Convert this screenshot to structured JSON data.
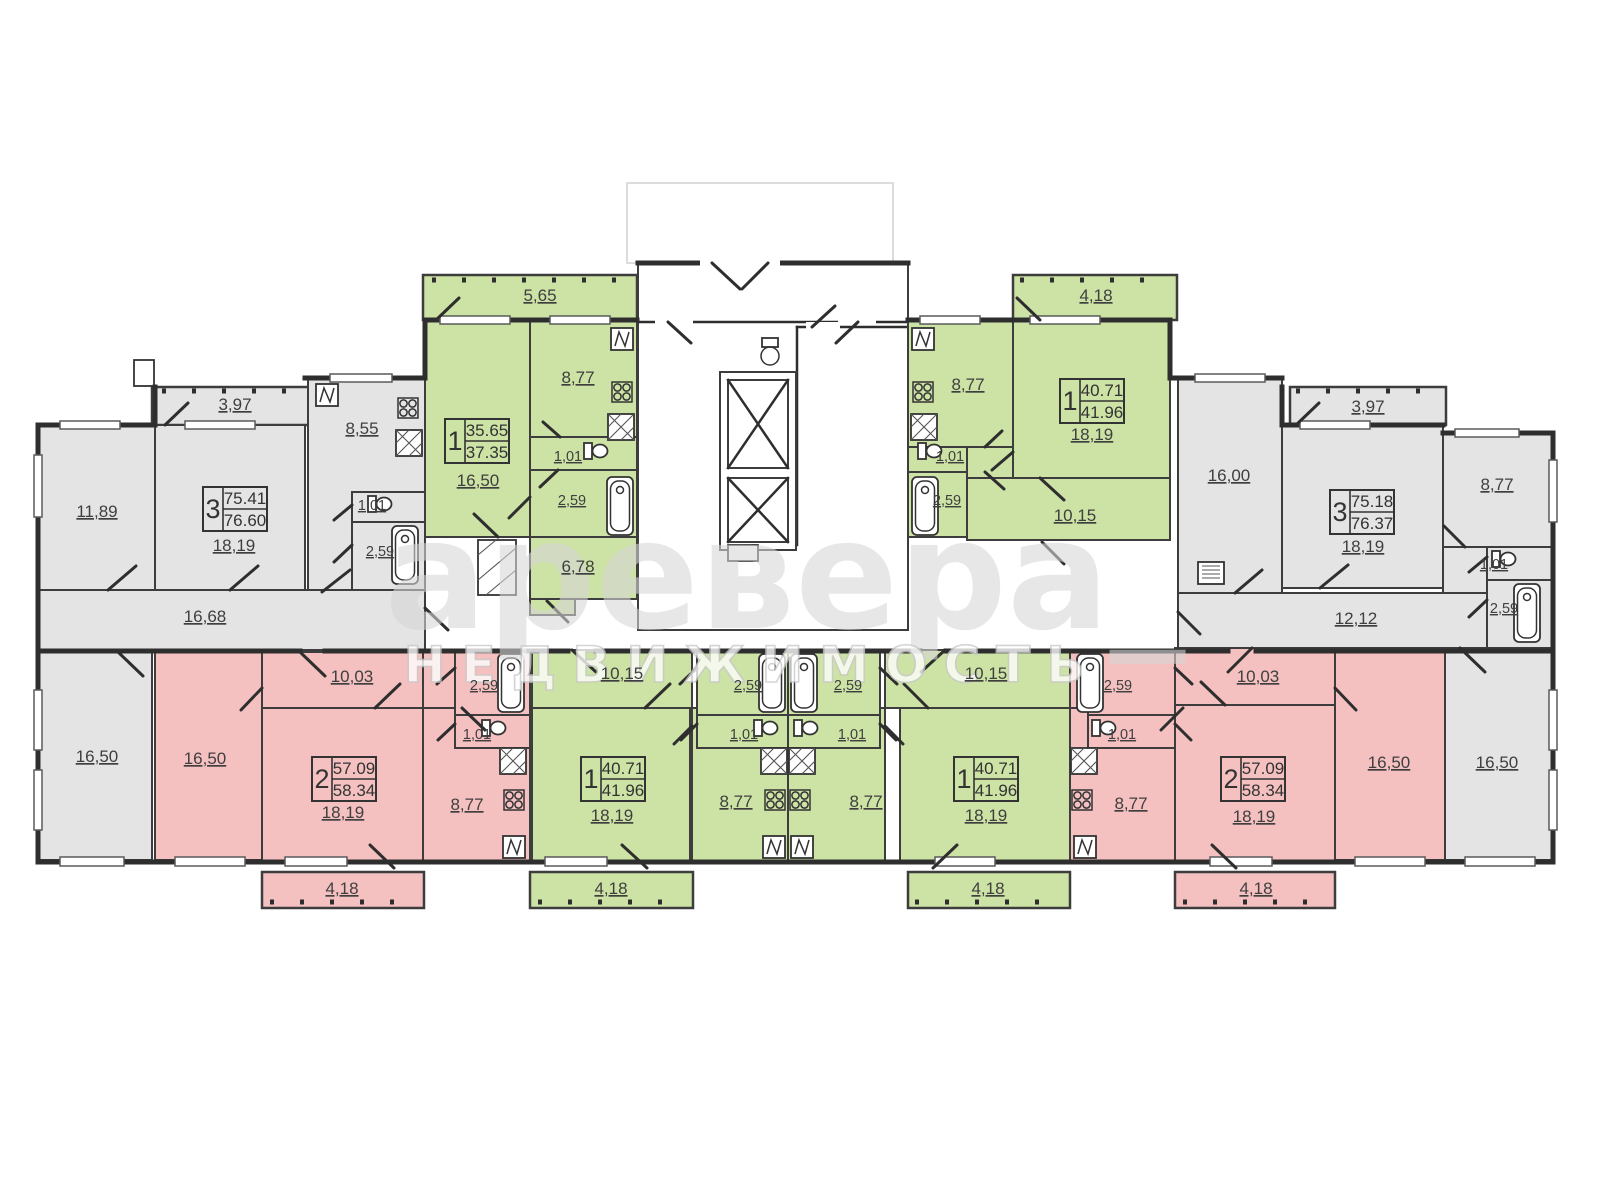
{
  "plan": {
    "watermark": {
      "brand": "аревера_",
      "subtitle": "НЕДВИЖИМОСТЬ"
    },
    "colors": {
      "sold_gray": "#e4e4e4",
      "one_room_green": "#cde3a5",
      "two_room_pink": "#f5c0c0",
      "wall": "#2e2e2e"
    },
    "apartments": [
      {
        "key": "top-left-3-room",
        "type_rooms": "3",
        "living_area": "75.41",
        "total_area": "76.60",
        "areas": {
          "bedroom1": "11,89",
          "balcony": "3,97",
          "living_room": "18,19",
          "kitchen": "8,55",
          "wc": "1,01",
          "bath": "2,59",
          "hall": "16,68",
          "bedroom2": "16,50"
        }
      },
      {
        "key": "top-mid-left-1-room",
        "type_rooms": "1",
        "living_area": "35.65",
        "total_area": "37.35",
        "areas": {
          "balcony": "5,65",
          "kitchen": "8,77",
          "living_room": "16,50",
          "wc": "1,01",
          "bath": "2,59",
          "hall": "6,78"
        }
      },
      {
        "key": "top-mid-right-1-room",
        "type_rooms": "1",
        "living_area": "40.71",
        "total_area": "41.96",
        "areas": {
          "balcony": "4,18",
          "kitchen": "8,77",
          "living_room": "18,19",
          "wc": "1,01",
          "bath": "2,59",
          "hall": "10,15"
        }
      },
      {
        "key": "top-right-3-room",
        "type_rooms": "3",
        "living_area": "75.18",
        "total_area": "76.37",
        "areas": {
          "bedroom1": "16,00",
          "balcony": "3,97",
          "living_room": "18,19",
          "kitchen": "8,77",
          "wc": "1,01",
          "bath": "2,59",
          "hall": "12,12",
          "bedroom2": "16,50"
        }
      },
      {
        "key": "bottom-left-2-room",
        "type_rooms": "2",
        "living_area": "57.09",
        "total_area": "58.34",
        "areas": {
          "bedroom": "16,50",
          "hall": "10,03",
          "living_room": "18,19",
          "kitchen": "8,77",
          "bath": "2,59",
          "wc": "1,01",
          "balcony": "4,18"
        }
      },
      {
        "key": "bottom-mid-left-1-room",
        "type_rooms": "1",
        "living_area": "40.71",
        "total_area": "41.96",
        "areas": {
          "hall": "10,15",
          "living_room": "18,19",
          "kitchen": "8,77",
          "bath": "2,59",
          "wc": "1,01",
          "balcony": "4,18"
        }
      },
      {
        "key": "bottom-mid-right-1-room",
        "type_rooms": "1",
        "living_area": "40.71",
        "total_area": "41.96",
        "areas": {
          "hall": "10,15",
          "living_room": "18,19",
          "kitchen": "8,77",
          "bath": "2,59",
          "wc": "1,01",
          "balcony": "4,18"
        }
      },
      {
        "key": "bottom-right-2-room",
        "type_rooms": "2",
        "living_area": "57.09",
        "total_area": "58.34",
        "areas": {
          "hall": "10,03",
          "living_room": "18,19",
          "bedroom": "16,50",
          "kitchen": "8,77",
          "bath": "2,59",
          "wc": "1,01",
          "balcony": "4,18"
        }
      }
    ]
  }
}
